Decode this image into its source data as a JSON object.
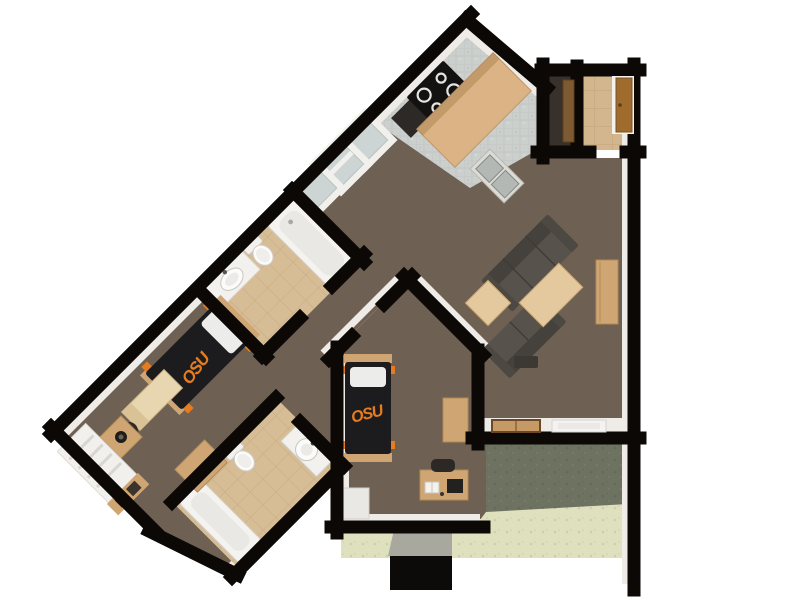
{
  "beds": {
    "bed1_label": "OSU",
    "bed2_label": "OSU"
  },
  "colors": {
    "wall": "#0b0805",
    "trim": "#efece7",
    "carpet": "#6e6052",
    "kitchen_tile": "#ccd0cd",
    "bath_tile": "#d7bd96",
    "entry_tile": "#d3b68e",
    "closet_dark": "#38302a",
    "patio_dark": "#6e7261",
    "patio_light": "#dfe0bd",
    "ramp_grey": "#a8a89e",
    "stoop_black": "#0d0b09",
    "island": "#dcb385",
    "wood": "#cfa673",
    "table_wood": "#e4c99e",
    "sofa": "#57534c",
    "sofa_dark": "#45423d",
    "mattress": "#1c1c1e",
    "osu_orange": "#e87b1e",
    "fixture_white": "#f2f1ee",
    "pale_interior": "#ccd5d3",
    "door_brown": "#a06c2e",
    "counter_black": "#2c2926",
    "stove_black": "#141210"
  }
}
